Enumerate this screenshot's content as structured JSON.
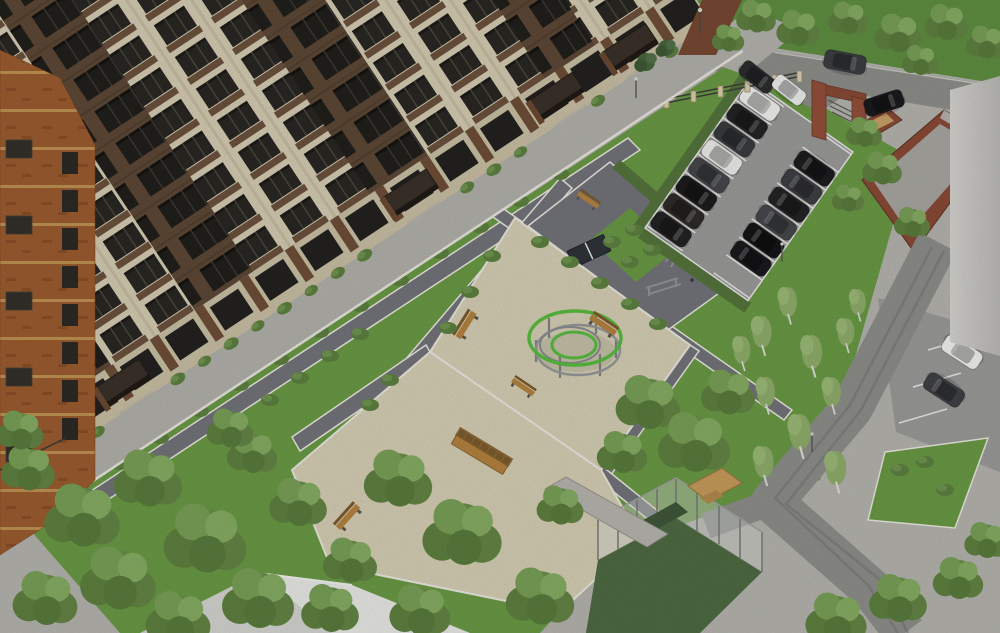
{
  "scene": {
    "title": "Aerial rendering of a residential apartment complex courtyard with playground, parking lot and landscaping",
    "view": "bird's-eye three-quarter view",
    "time_of_day": "daytime, overcast soft light"
  },
  "palette": {
    "facade_beige": "#d5ccb2",
    "facade_brick": "#5d4836",
    "spandrel_brick": "#6b513c",
    "window_glass": "#292723",
    "corner_orange": "#9c5c30",
    "canopy_dark": "#3a3129",
    "sidewalk": "#b2b1ab",
    "pavement": "#b5b4ae",
    "path_dark": "#73747a",
    "curb_white": "#eae8df",
    "lawn_green": "#6a9a45",
    "lawn_dark": "#5f8f41",
    "field_green": "#4e6b43",
    "hedge_green": "#55743c",
    "tree_green": "#6b8f4c",
    "gravel_sand": "#d6cfb5",
    "play_ring_green": "#58bc40",
    "equipment_gray": "#90959a",
    "asphalt": "#9b9b99",
    "road_gray": "#8e8f8b",
    "brick_red": "#8a4a36",
    "enclosure_floor": "#a8a7a2",
    "roof_white": "#e9e9e6",
    "roof_dim": "#d4d4d0",
    "bench_wood": "#b5823f",
    "stall_line": "#e8e8e6",
    "adjacent_wall": "#cdccc8",
    "pavilion_wood": "#c79c5c"
  },
  "building": {
    "type": "multi-storey residential block",
    "floors_visible": 11,
    "materials": [
      "beige stone piers",
      "brown brick bays",
      "orange brick corner"
    ],
    "entrance_canopies": 4,
    "balconies": "dark recessed balconies in brick bays",
    "ground_floor": "terraces with brick piers and planters"
  },
  "courtyard": {
    "paths": "dark pavers edged with white curbs in diagonal grid",
    "benches_small": 5,
    "benches_long_canopy": 1,
    "table_tennis_tables": 1,
    "fitness_equipment": [
      "pull-up arch",
      "parallel bars",
      "outdoor gym stations"
    ],
    "lamps": 4,
    "lawns_with_bushes": true
  },
  "playground": {
    "surface": "sand-colored gravel square seen as diamond",
    "structure": "circular rope-climbing carousel",
    "green_rings": 2,
    "gray_rails": 2,
    "support_posts": 6
  },
  "parking": {
    "main_lot": {
      "rows": 2,
      "col_a_colors": [
        "#232325",
        "#2e2a28",
        "#1c1c1e",
        "#45474b",
        "#ededeb",
        "#3a3b3f",
        "#242426",
        "#f1f1ef"
      ],
      "col_b_colors": [
        "#1a1a1c",
        "#151517",
        "#46484c",
        "#242426",
        "#3d3f43",
        "#1d1d1f"
      ],
      "hedge_border": true
    },
    "right_bays_colors": [
      "#f2f2f0",
      "#3f4145"
    ],
    "access_road_colors": [
      "#2b2d2f",
      "#eeeeec"
    ],
    "street_car_color": "#3c3e42",
    "enclosure_car_color": "#1b1b1d",
    "total_cars_visible": 19
  },
  "streets": {
    "top_road": "asphalt road along upper lawn",
    "side_road": "road with tire tracks curving to bottom right",
    "fence_pillars": 7
  },
  "structures": {
    "entrance_gate": "red-brick portal frame at parking entry",
    "utility_enclosure": "brick-walled yard with concrete floor",
    "sports_fence": "tall mesh fence around dark-green court (bottom center)",
    "wooden_pavilion": "small timber deck near sports court",
    "white_roof_building": "large white pitched roof, bottom-left corner",
    "adjacent_wall": "pale building edge along right margin"
  },
  "vegetation": {
    "tree_clusters": [
      "dense trees bottom-left",
      "trees south of playground",
      "birch strip along side road",
      "lawn trees top-right",
      "trees bottom-right"
    ],
    "hedgerows": [
      "around parking lot",
      "along fitness zone"
    ],
    "bush_rows": "low shrubs lining paths and planters"
  }
}
